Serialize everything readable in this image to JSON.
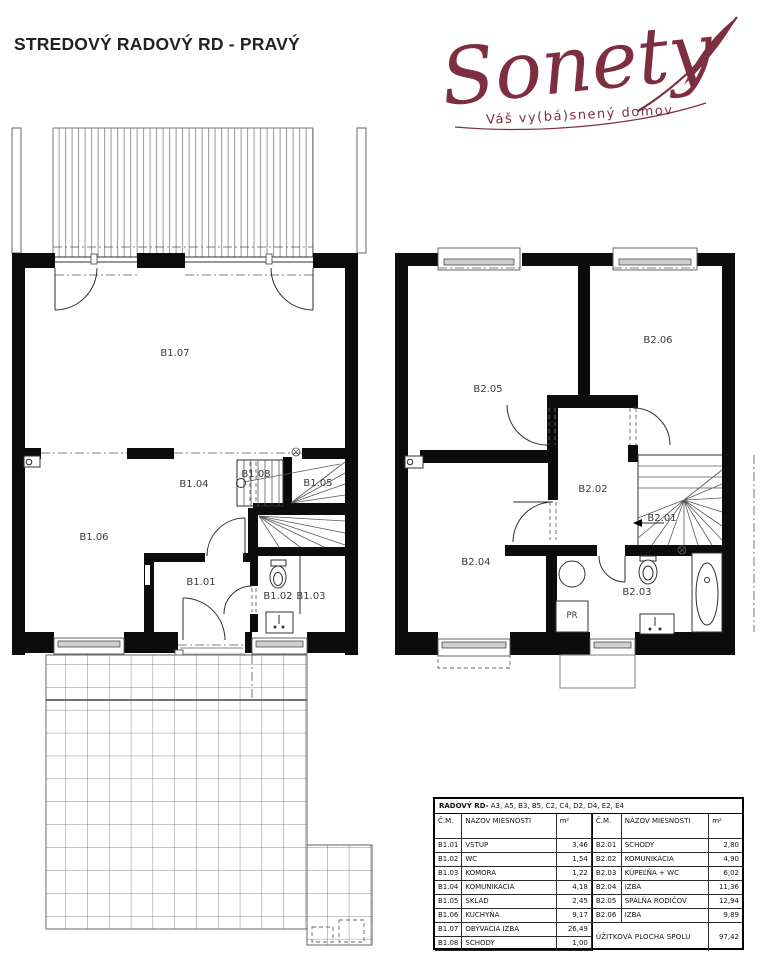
{
  "header": {
    "title": "STREDOVÝ RADOVÝ RD - PRAVÝ"
  },
  "logo": {
    "brand": "Sonety",
    "tagline": "Váš vy(bá)snený domov",
    "color": "#7e2f3f"
  },
  "plans": {
    "ground": {
      "labels": {
        "b101": "B1.01",
        "b102": "B1.02",
        "b103": "B1.03",
        "b104": "B1.04",
        "b105": "B1.05",
        "b106": "B1.06",
        "b107": "B1.07",
        "b108": "B1.08"
      }
    },
    "upper": {
      "labels": {
        "b201": "B2.01",
        "b202": "B2.02",
        "b203": "B2.03",
        "b204": "B2.04",
        "b205": "B2.05",
        "b206": "B2.06",
        "pr": "PR"
      }
    }
  },
  "table": {
    "title_prefix": "RADOVÝ RD-",
    "title_units": " A3, A5, B3, B5, C2, C4, D2, D4, E2, E4",
    "col_cm": "Č.M.",
    "col_name": "NÁZOV MIESNOSTI",
    "col_m2": "m²",
    "left_rows": [
      {
        "id": "B1.01",
        "name": "VSTUP",
        "area": "3,46"
      },
      {
        "id": "B1.02",
        "name": "WC",
        "area": "1,54"
      },
      {
        "id": "B1.03",
        "name": "KOMORA",
        "area": "1,22"
      },
      {
        "id": "B1.04",
        "name": "KOMUNIKÁCIA",
        "area": "4,18"
      },
      {
        "id": "B1.05",
        "name": "SKLAD",
        "area": "2,45"
      },
      {
        "id": "B1.06",
        "name": "KUCHYŇA",
        "area": "9,17"
      },
      {
        "id": "B1.07",
        "name": "OBÝVACIA IZBA",
        "area": "26,49"
      },
      {
        "id": "B1.08",
        "name": "SCHODY",
        "area": "1,00"
      }
    ],
    "right_rows": [
      {
        "id": "B2.01",
        "name": "SCHODY",
        "area": "2,80"
      },
      {
        "id": "B2.02",
        "name": "KOMUNIKÁCIA",
        "area": "4,90"
      },
      {
        "id": "B2.03",
        "name": "KÚPEĽŇA + WC",
        "area": "6,02"
      },
      {
        "id": "B2.04",
        "name": "IZBA",
        "area": "11,36"
      },
      {
        "id": "B2.05",
        "name": "SPÁLŇA RODIČOV",
        "area": "12,94"
      },
      {
        "id": "B2.06",
        "name": "IZBA",
        "area": "9,89"
      }
    ],
    "total_label": "ÚŽITKOVÁ PLOCHA SPOLU",
    "total_value": "97,42"
  }
}
